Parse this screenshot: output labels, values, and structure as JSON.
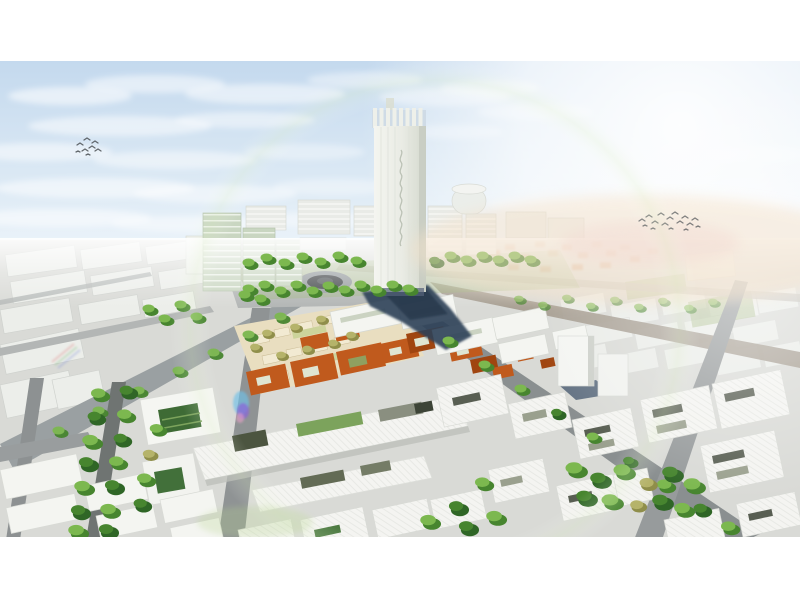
{
  "meta": {
    "type": "architectural-rendering",
    "subject": "Aerial 3D masterplan rendering: a tall white landmark tower above a city district with a roundabout, orange-roofed market blocks, beige historic fabric, white courtyard buildings, tree-lined streets, clouds, bird flocks and lens flares",
    "tower_signage_legible": false,
    "bird_count_left": 8,
    "bird_count_right": 16
  },
  "palette": {
    "page_bg": "#ffffff",
    "sky_top": "#c4d9ee",
    "sky_mid": "#dae8f4",
    "sky_bottom": "#eef5fb",
    "cloud": "#ffffff",
    "sun_glow": "#ffffff",
    "warm_haze": "#f4e2cb",
    "pink_haze": "#f3d9d2",
    "ground": "#d9dad6",
    "road": "#9aa0a2",
    "road_dark": "#6f7472",
    "road_light": "#b3b6b5",
    "road_warm": "#a39a8e",
    "block_white": "#f4f5f1",
    "block_line": "#d7d9d4",
    "far_block": "#eef0ec",
    "cream": "#efe9d8",
    "glass_green": "#c9d6c1",
    "glass_line": "#ecf1e8",
    "tower_face": "#f4f5f0",
    "tower_side": "#d3d8cc",
    "tower_crown": "#eef0ea",
    "shadow_navy": "#2e4156",
    "shadow_core": "#24364a",
    "shadow_blue": "#3c5068",
    "orange_roof": "#c05a1d",
    "orange_dark": "#a04510",
    "orange_far": "#cc7030",
    "beige": "#e9dec0",
    "beige_roof": "#f2ead2",
    "olive_light": "#b5b36a",
    "olive_dark": "#8f8e4a",
    "tree_light": "#7cb84f",
    "tree_dark": "#47852f",
    "tree_deep": "#2f6626",
    "lawn": "#aebf8e",
    "park_green": "#9cb574",
    "court_green": "#3e6b35",
    "court_stripe": "#7ca35c",
    "slot_dark": "#585e52",
    "slot_green": "#8fa060",
    "skylight": "#cbd3c2",
    "roundabout_ring": "#989da0",
    "roundabout_core": "#45494c",
    "roundabout_inner": "#5a5f62",
    "bird": "#4b5054",
    "flare_purple": "#8a62d8",
    "flare_cyan": "#6fc0e8",
    "flare_pink": "#e8a0c8",
    "flare_green": "#b9d693"
  },
  "birds": {
    "left": [
      "M77 145l3 -2 3 2",
      "M84 140l3 -2 3 2",
      "M89 148l3 -2 3 2",
      "M82 151l3 -2 3 2",
      "M92 143l3 -2 3 2",
      "M95 151l3 -2 3 2",
      "M86 155l2 -1 2 1",
      "M76 152l2 -1 2 1"
    ],
    "right": [
      "M639 221l3 -2 3 2",
      "M646 217l3 -2 3 2",
      "M652 223l3 -2 3 2",
      "M658 215l3 -2 3 2",
      "M662 225l3 -2 3 2",
      "M667 219l3 -2 3 2",
      "M672 214l3 -2 3 2",
      "M677 223l3 -2 3 2",
      "M682 218l3 -2 3 2",
      "M687 225l3 -2 3 2",
      "M692 220l3 -2 3 2",
      "M651 229l2 -1 2 1",
      "M669 229l2 -1 2 1",
      "M684 230l2 -1 2 1",
      "M696 227l2 -1 2 1",
      "M643 226l2 -1 2 1"
    ]
  }
}
